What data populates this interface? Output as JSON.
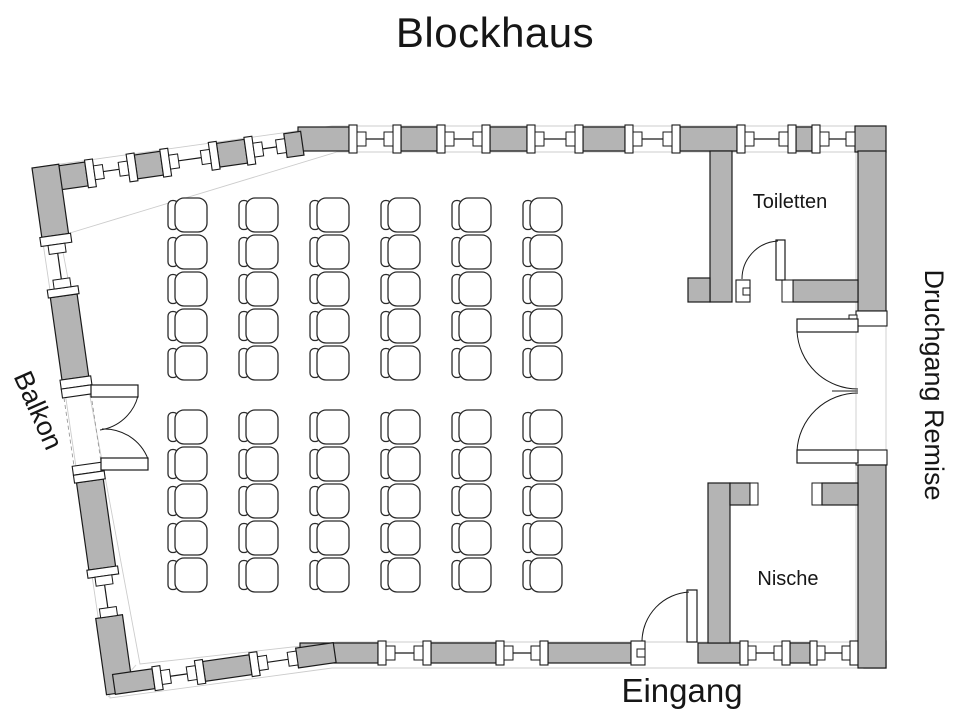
{
  "title": "Blockhaus",
  "labels": {
    "toiletten": "Toiletten",
    "nische": "Nische",
    "balkon": "Balkon",
    "druchgang_remise": "Druchgang Remise",
    "eingang": "Eingang"
  },
  "colors": {
    "wall_fill": "#b4b4b4",
    "line": "#1a1a1a",
    "background": "#ffffff"
  },
  "seating": {
    "total_seats": 60,
    "blocks": [
      {
        "name": "front-seat-block",
        "rows": 5,
        "cols": 6,
        "x0": 168,
        "y0": 198,
        "col_step": 71,
        "row_step": 37
      },
      {
        "name": "rear-seat-block",
        "rows": 5,
        "cols": 6,
        "x0": 168,
        "y0": 410,
        "col_step": 71,
        "row_step": 37
      }
    ]
  }
}
